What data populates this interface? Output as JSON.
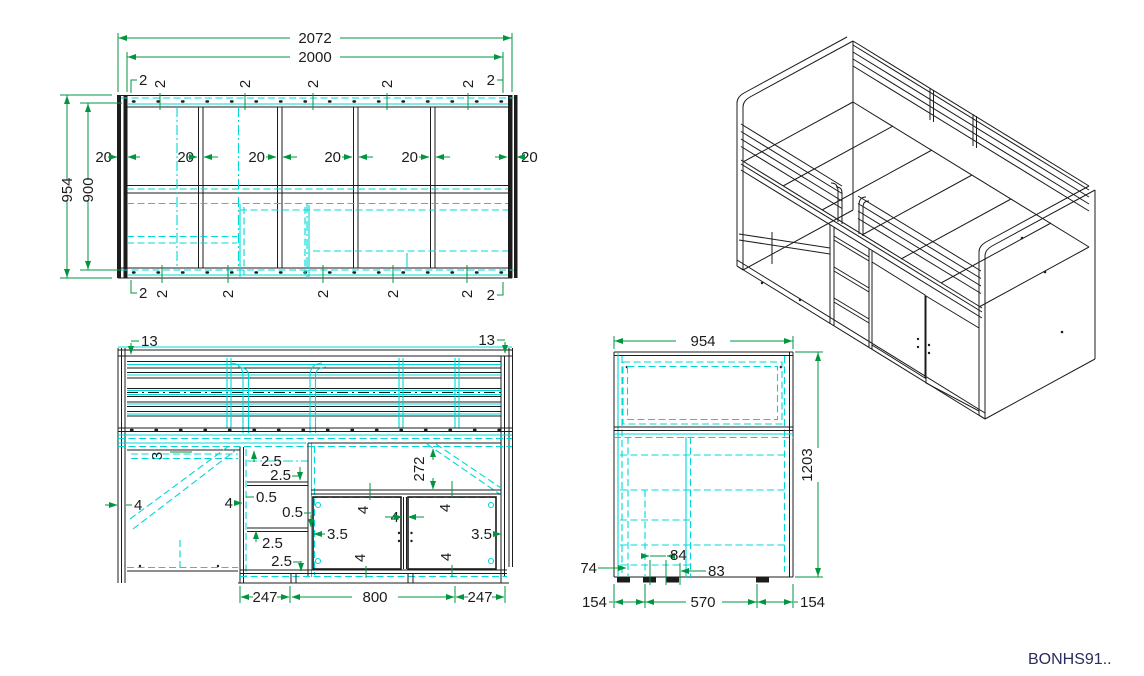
{
  "drawing_code": "BONHS91..",
  "palette": {
    "cyan": "#00d8d8",
    "green": "#009640",
    "ink": "#1c1c1c",
    "code_ink": "#2b2b5e"
  },
  "views": {
    "top": {
      "name": "top view",
      "width_total": "2072",
      "width_inner": "2000",
      "depth_total": "954",
      "depth_inner": "900",
      "slat_width": "20",
      "slat_gap": "2"
    },
    "front": {
      "name": "front view",
      "rail_offset": "13",
      "desk_top": "3",
      "gap_25": "2.5",
      "gap_05": "0.5",
      "panel_4": "4",
      "opening_height": "272",
      "clearance_35": "3.5",
      "shelf_width": "247",
      "doors_width": "800"
    },
    "side": {
      "name": "side view",
      "depth": "954",
      "height": "1203",
      "plinth": "74",
      "foot_gap": "84",
      "foot": "83",
      "margin": "154",
      "span": "570"
    },
    "iso": {
      "name": "isometric view"
    }
  }
}
